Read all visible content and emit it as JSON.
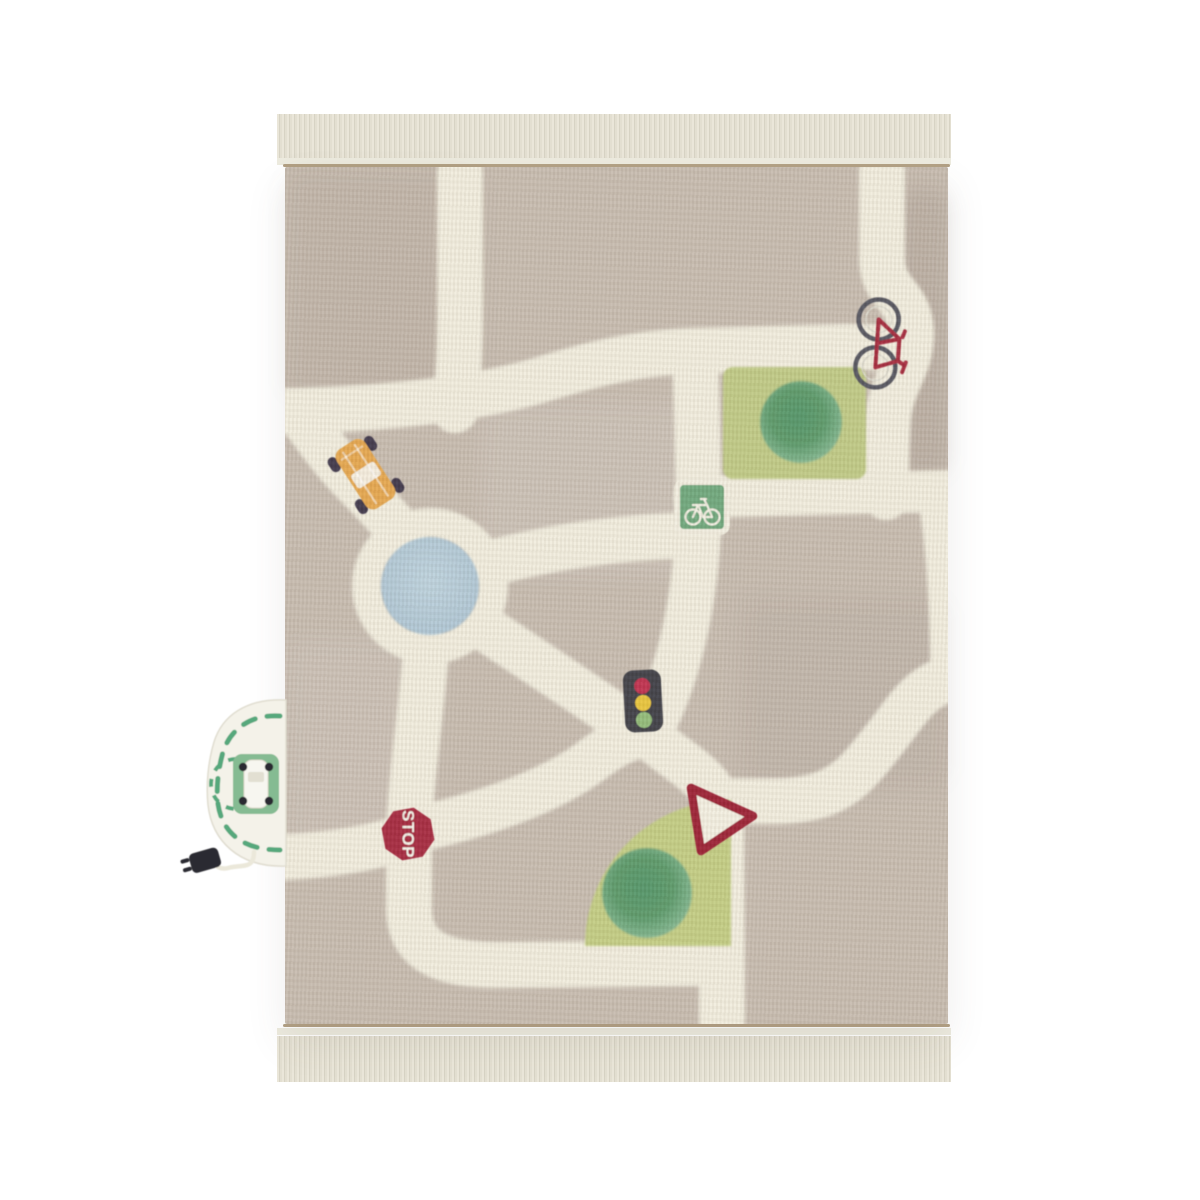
{
  "scene": {
    "description": "Top-down product photo of a children's road-map play rug with tassel fringe on a plain white background",
    "background_color": "#ffffff"
  },
  "rug": {
    "base_color": "#c7bcb0",
    "road_color": "#f1edde",
    "fringe_color": "#e3dfd1",
    "selvedge_color": "#b3a185",
    "roundabout": {
      "description": "circular roundabout with pond in the middle",
      "pond_color": "#b6ccd8"
    },
    "parks": [
      {
        "name": "square park upper right",
        "grass_color": "#c0ca86",
        "bush_color": "#5c9a6b"
      },
      {
        "name": "quarter-circle park lower center",
        "grass_color": "#c3cd84",
        "bush_color": "#5c9a6b"
      }
    ],
    "bike_lane_sign": {
      "glyph": "bicycle",
      "panel_color": "#6fa87d",
      "glyph_color": "#f2efe2"
    },
    "traffic_light": {
      "body_color": "#414146",
      "lights": [
        "#c03050",
        "#e9c53e",
        "#93bc7a"
      ]
    },
    "stop_sign": {
      "label": "STOP",
      "panel_color": "#a6293f",
      "text_color": "#f4f1e8"
    },
    "yield_sign": {
      "border_color": "#9c2136",
      "fill_color": "#f3efe1"
    },
    "taxi_car": {
      "body_color": "#e5a74f",
      "window_color": "#f6f3ea",
      "wheel_color": "#3f374b"
    },
    "bicycle": {
      "frame_color": "#a52a3c",
      "wheel_color": "#55555e"
    },
    "charging_station": {
      "description": "detachable half-oval parking patch with plug cable on left edge",
      "patch_color": "#f4f2e9",
      "dash_color": "#56a87c",
      "pad_color": "#85bb92",
      "car_color": "#f7f6f0",
      "plug_color": "#2b2b31",
      "cord_color": "#ebe8da"
    }
  }
}
